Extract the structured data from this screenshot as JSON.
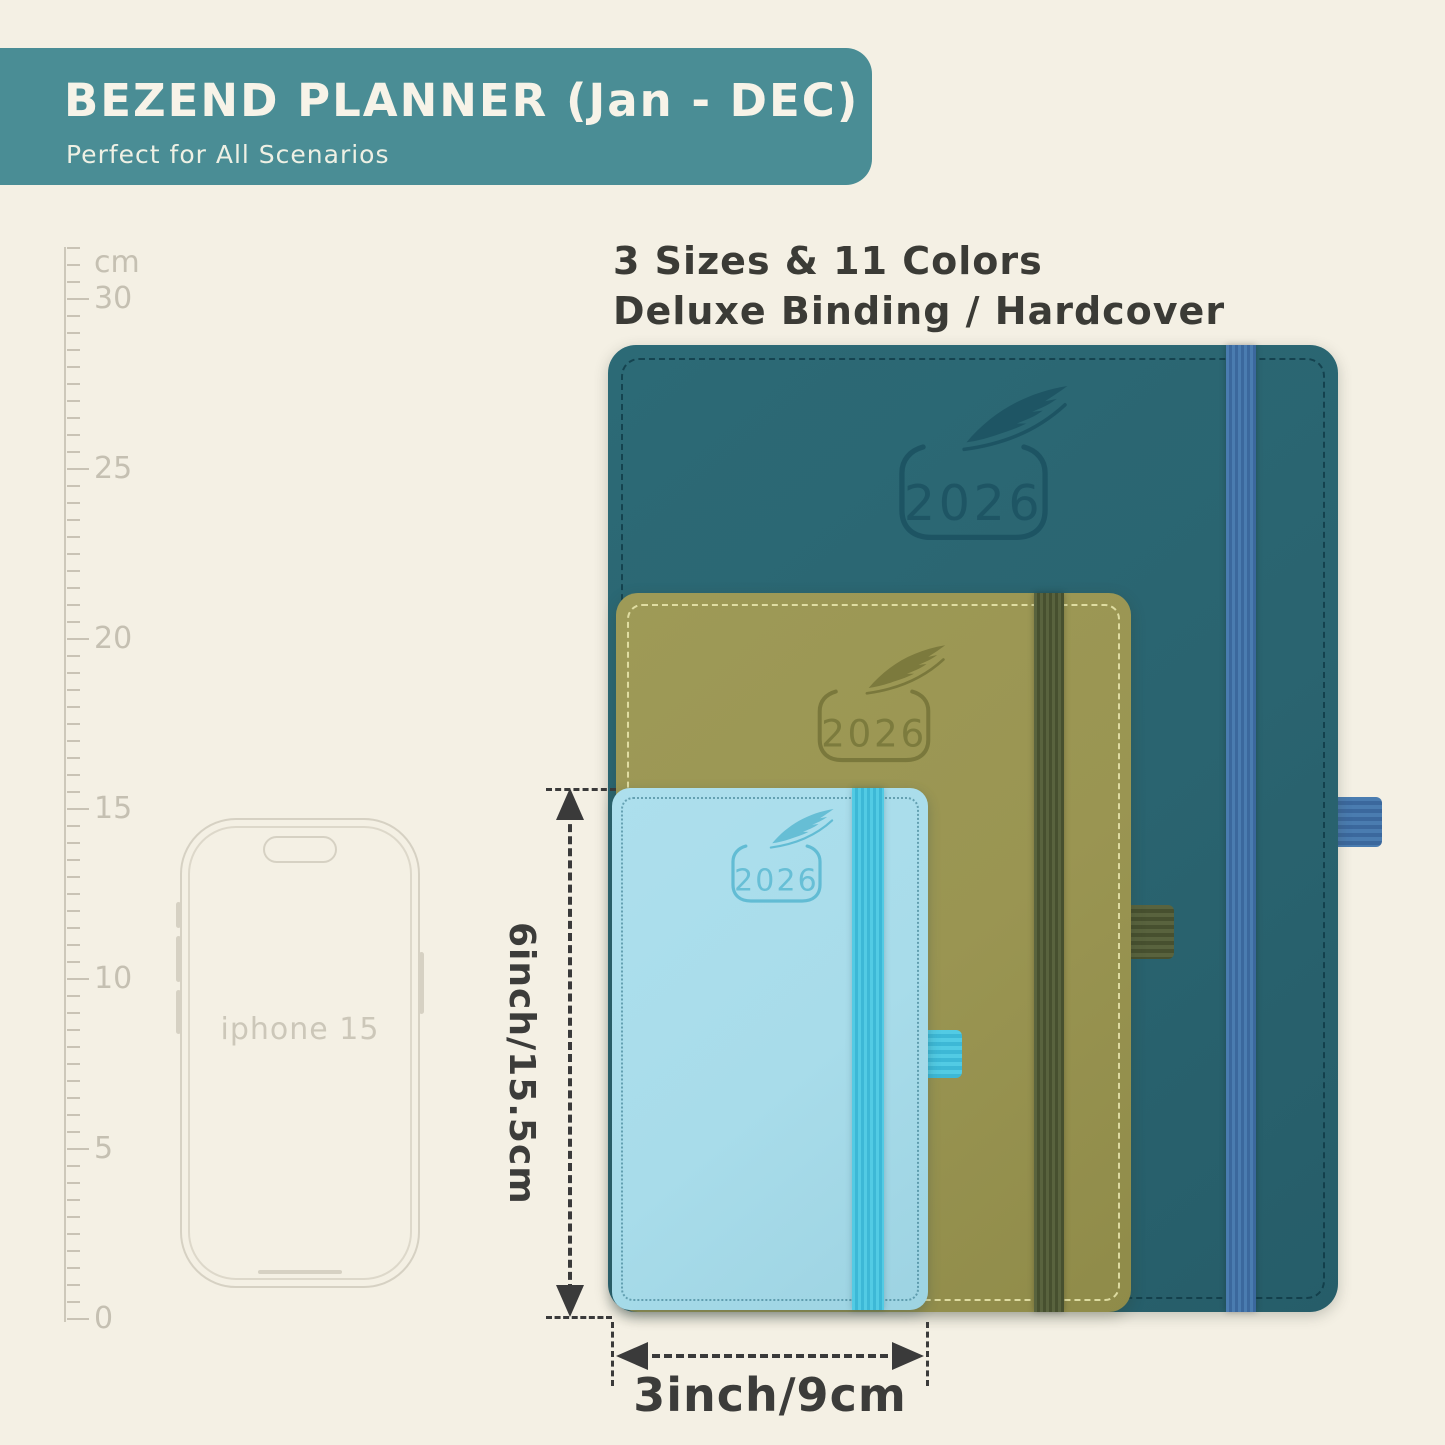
{
  "banner": {
    "title": "BEZEND PLANNER (Jan - DEC)",
    "subtitle": "Perfect for All Scenarios",
    "bg_color": "#4a8d95",
    "text_color": "#f7f3e8"
  },
  "info": {
    "line1": "3 Sizes & 11 Colors",
    "line2": "Deluxe Binding / Hardcover"
  },
  "ruler": {
    "labels": [
      "cm",
      "30",
      "25",
      "20",
      "15",
      "10",
      "5",
      "0"
    ],
    "tick_color": "#c9c3b5"
  },
  "phone": {
    "label": "iphone 15",
    "outline_color": "#d6d1c3"
  },
  "planners": [
    {
      "size": "large",
      "year": "2026",
      "cover_color": "#2a6470",
      "band_color": "#4a7cb0",
      "loop": "pen-loop"
    },
    {
      "size": "medium",
      "year": "2026",
      "cover_color": "#9a9552",
      "band_color": "#59633e",
      "loop": "pen-loop"
    },
    {
      "size": "small",
      "year": "2026",
      "cover_color": "#a8dcea",
      "band_color": "#4dc8e1",
      "loop": "pen-loop"
    }
  ],
  "dimensions": {
    "height_label": "6inch/15.5cm",
    "width_label": "3inch/9cm",
    "line_color": "#3a3a3a"
  },
  "background_color": "#f4f0e4"
}
